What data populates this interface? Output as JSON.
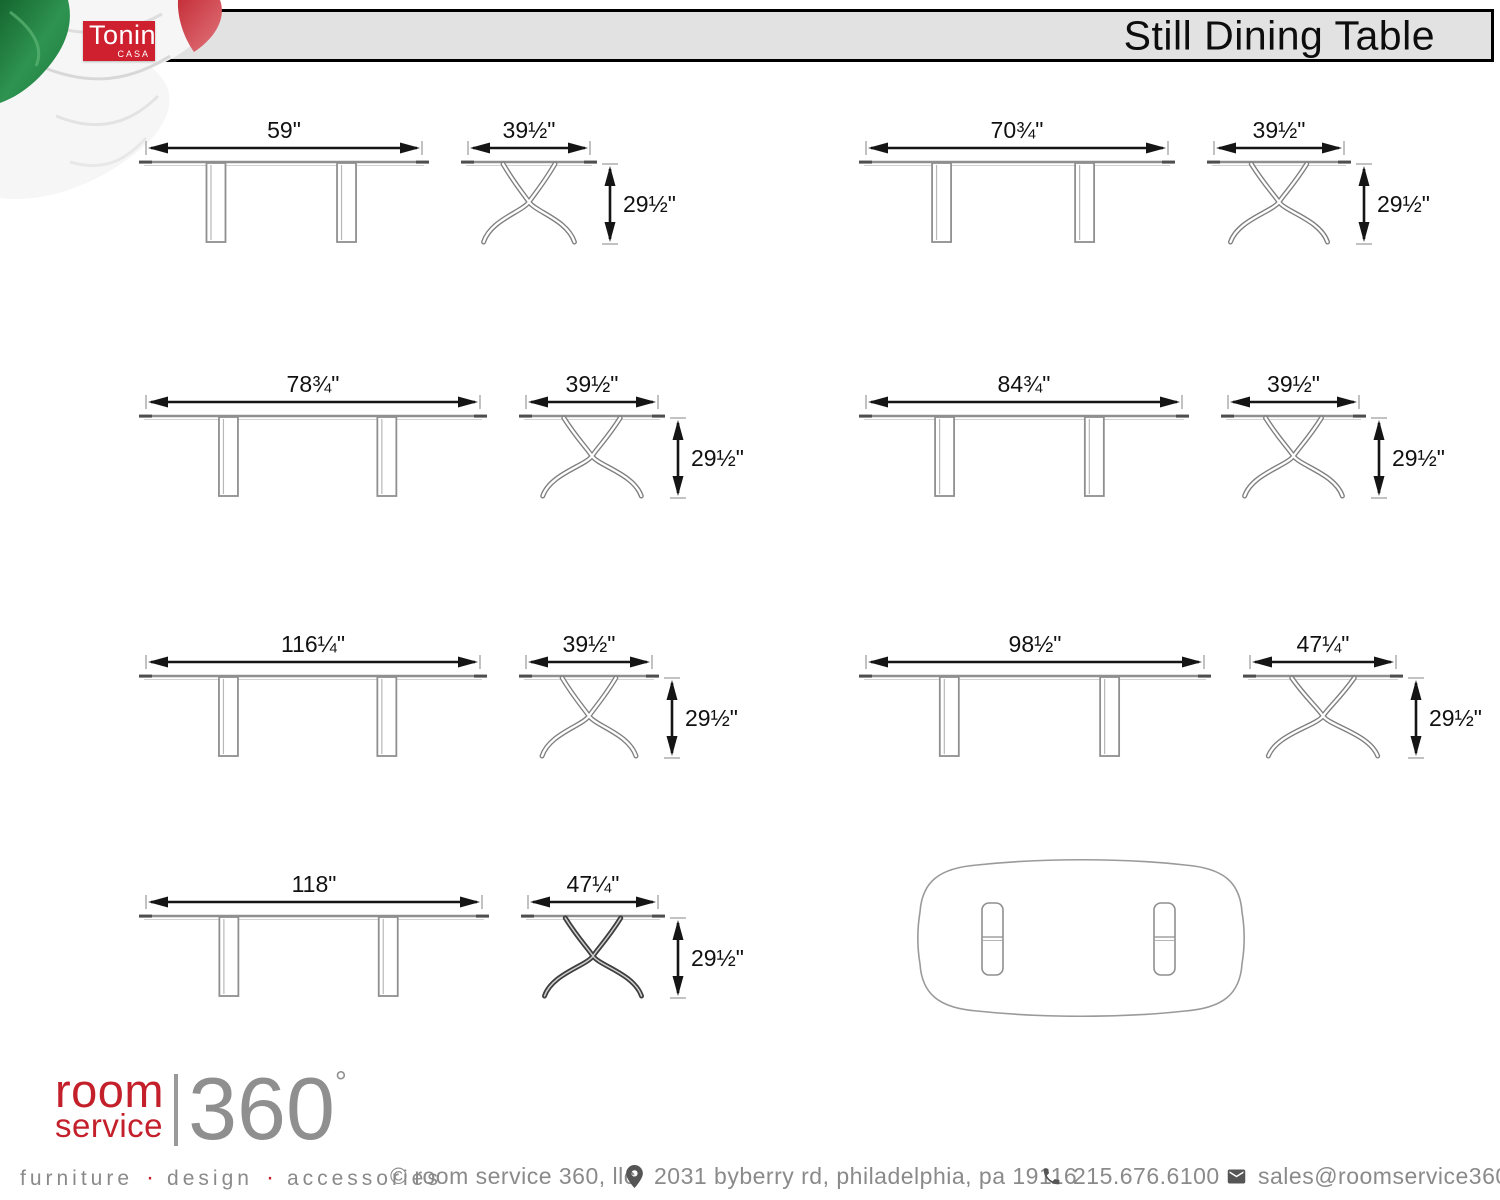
{
  "header": {
    "brand_name": "Tonin",
    "brand_sub": "CASA",
    "title": "Still Dining Table"
  },
  "variants": [
    {
      "width": "59\"",
      "depth": "39½\"",
      "height": "29½\""
    },
    {
      "width": "70¾\"",
      "depth": "39½\"",
      "height": "29½\""
    },
    {
      "width": "78¾\"",
      "depth": "39½\"",
      "height": "29½\""
    },
    {
      "width": "84¾\"",
      "depth": "39½\"",
      "height": "29½\""
    },
    {
      "width": "116¼\"",
      "depth": "39½\"",
      "height": "29½\""
    },
    {
      "width": "98½\"",
      "depth": "47¼\"",
      "height": "29½\""
    },
    {
      "width": "118\"",
      "depth": "47¼\"",
      "height": "29½\""
    }
  ],
  "footer": {
    "logo": {
      "word1": "room",
      "word2": "service",
      "number": "360",
      "degree_symbol": "°"
    },
    "tagline": {
      "item1": "furniture",
      "item2": "design",
      "item3": "accessories",
      "separator": "·"
    },
    "copyright": "© room service 360, llc",
    "address": "2031 byberry rd, philadelphia, pa 19116",
    "phone": "215.676.6100",
    "email": "sales@roomservice360.com"
  },
  "colors": {
    "tonin_red": "#cf2030",
    "logo_red": "#c4202b",
    "band_gray": "#e2e2e2",
    "drawing_gray": "#8f8f8f",
    "dimension_black": "#151515",
    "footer_gray": "#8a8a8a"
  }
}
